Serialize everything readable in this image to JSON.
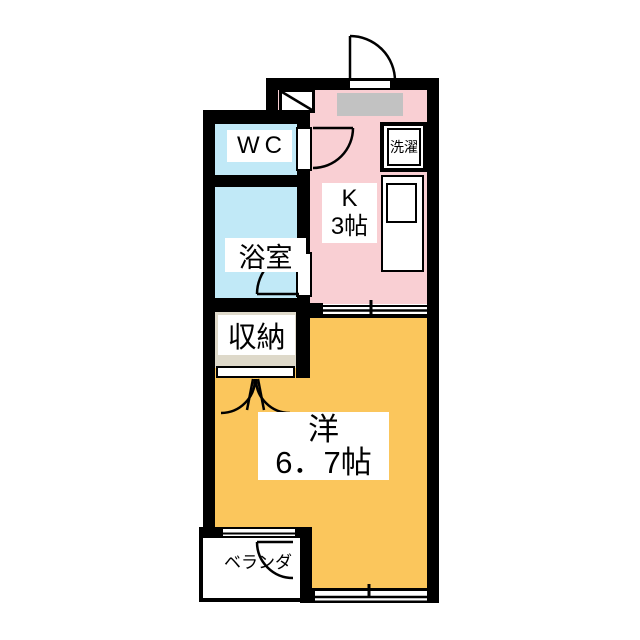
{
  "colors": {
    "wall": "#000000",
    "kitchen_floor": "#f9cfd3",
    "water_floor": "#c1e9f7",
    "storage_floor": "#ded9ca",
    "main_floor": "#fbc65c",
    "entry_mat": "#c2c2c2",
    "background": "#ffffff"
  },
  "rooms": {
    "wc": {
      "label": "WC"
    },
    "bath": {
      "label": "浴室"
    },
    "kitchen": {
      "name": "K",
      "size": "3帖"
    },
    "storage": {
      "label": "収納"
    },
    "western_room": {
      "name": "洋",
      "size": "6．7帖"
    },
    "veranda": {
      "label": "ベランダ"
    }
  },
  "fixtures": {
    "laundry": {
      "label": "洗濯"
    }
  }
}
